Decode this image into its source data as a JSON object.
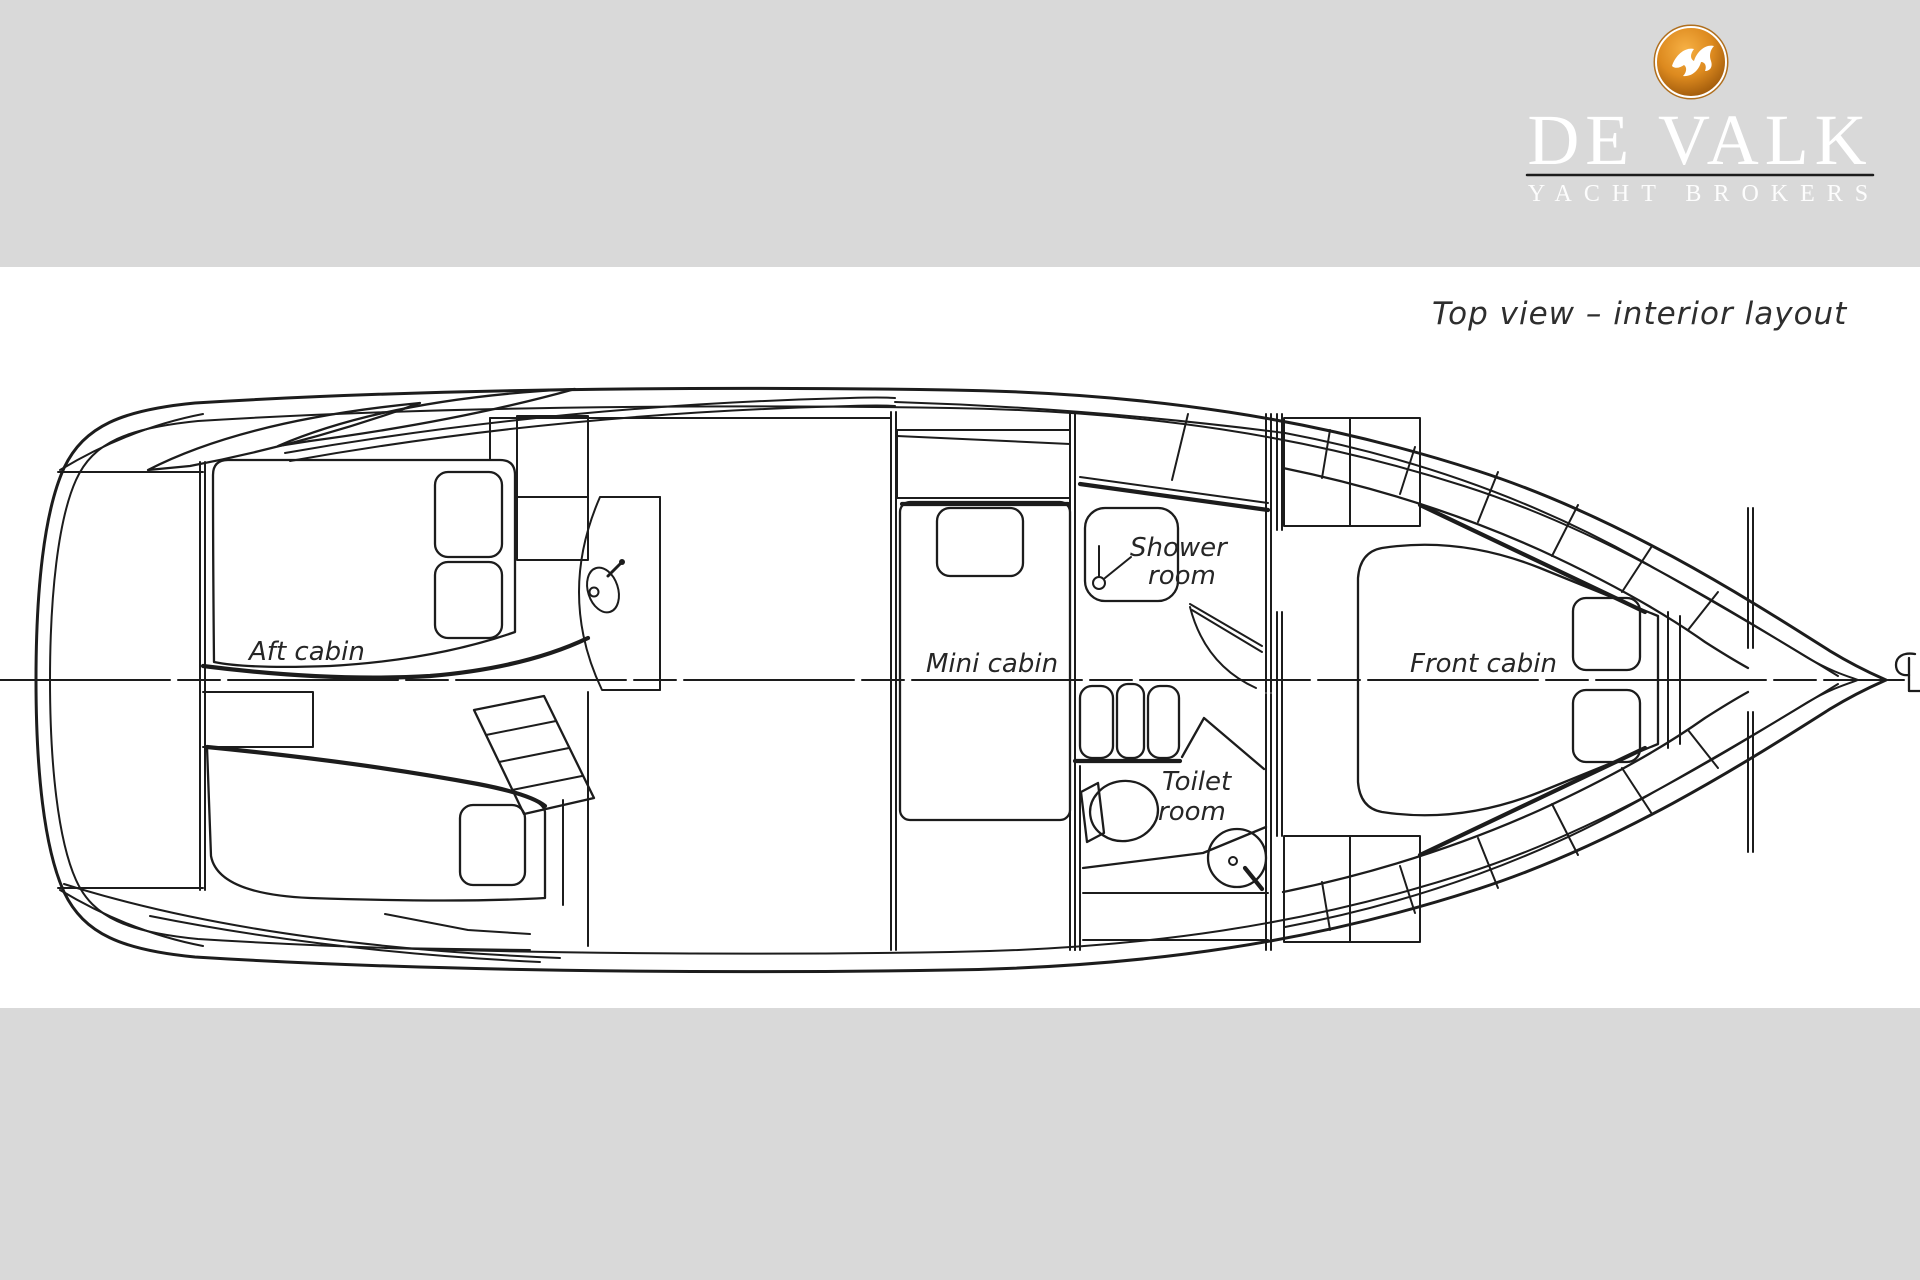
{
  "colors": {
    "band": "#d9d9d9",
    "paper": "#ffffff",
    "line": "#1c1c1c",
    "label_text": "#262626",
    "logo_orange_light": "#f6b044",
    "logo_orange_mid": "#dd8a1f",
    "logo_orange_dark": "#8f4d06",
    "logo_text": "#ffffff"
  },
  "logo": {
    "brand": "DE VALK",
    "tagline": "YACHT BROKERS",
    "icon": "falcon-badge"
  },
  "drawing": {
    "title": "Top view – interior layout",
    "labels": {
      "aft_cabin": "Aft cabin",
      "mini_cabin": "Mini cabin",
      "shower_line1": "Shower",
      "shower_line2": "room",
      "toilet_line1": "Toilet",
      "toilet_line2": "room",
      "front_cabin": "Front cabin"
    },
    "rooms": [
      {
        "name": "Aft cabin"
      },
      {
        "name": "Mini cabin"
      },
      {
        "name": "Shower room"
      },
      {
        "name": "Toilet room"
      },
      {
        "name": "Front cabin"
      }
    ],
    "annotations": {
      "centerline_symbol": "CL"
    }
  }
}
